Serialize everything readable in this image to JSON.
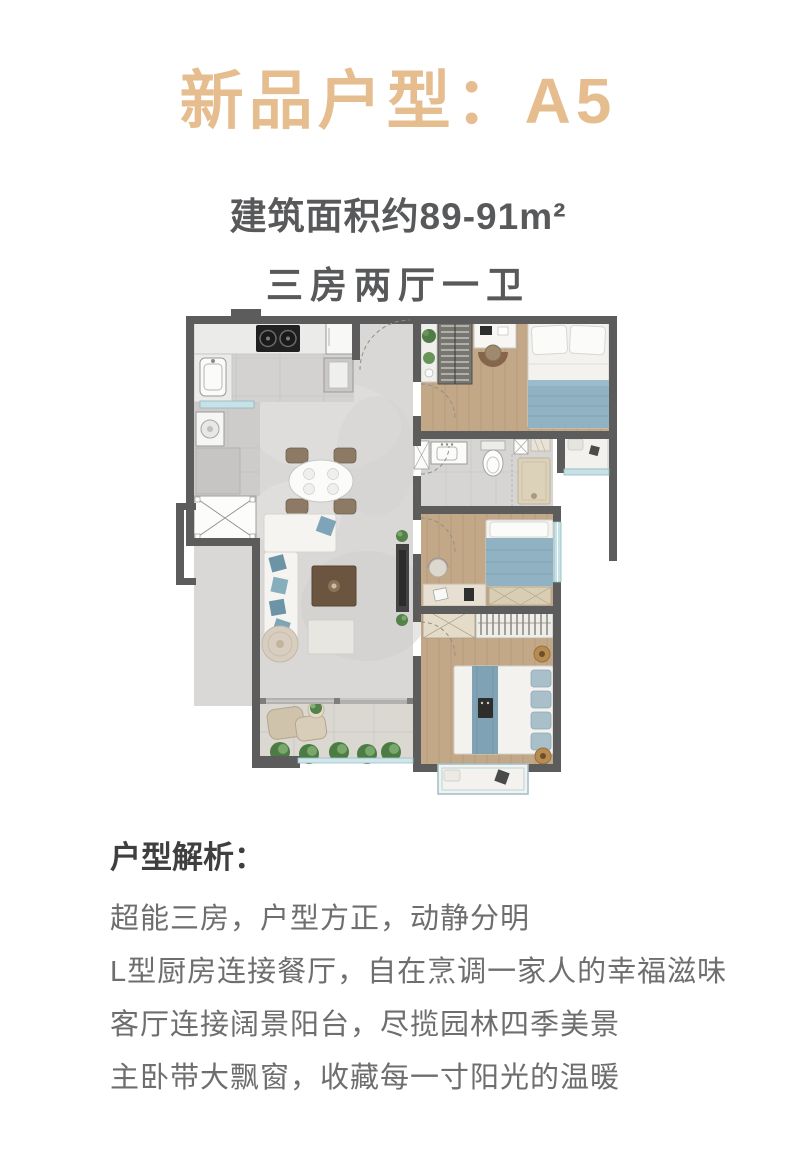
{
  "header": {
    "title": "新品户型：A5"
  },
  "specs": {
    "area": "建筑面积约89-91m²",
    "layout": "三房两厅一卫"
  },
  "analysis": {
    "heading": "户型解析：",
    "points": [
      "超能三房，户型方正，动静分明",
      "L型厨房连接餐厅，自在烹调一家人的幸福滋味",
      "客厅连接阔景阳台，尽揽园林四季美景",
      "主卧带大飘窗，收藏每一寸阳光的温暖"
    ]
  },
  "colors": {
    "accent_gold": "#E6BD8E",
    "text_dark": "#58595B",
    "text_body": "#6E6E6E",
    "wall_gray": "#5C5C5C",
    "bed_blue": "#90B2C3",
    "wood_floor": "#C3A888",
    "window_blue": "#C6E2E7"
  }
}
